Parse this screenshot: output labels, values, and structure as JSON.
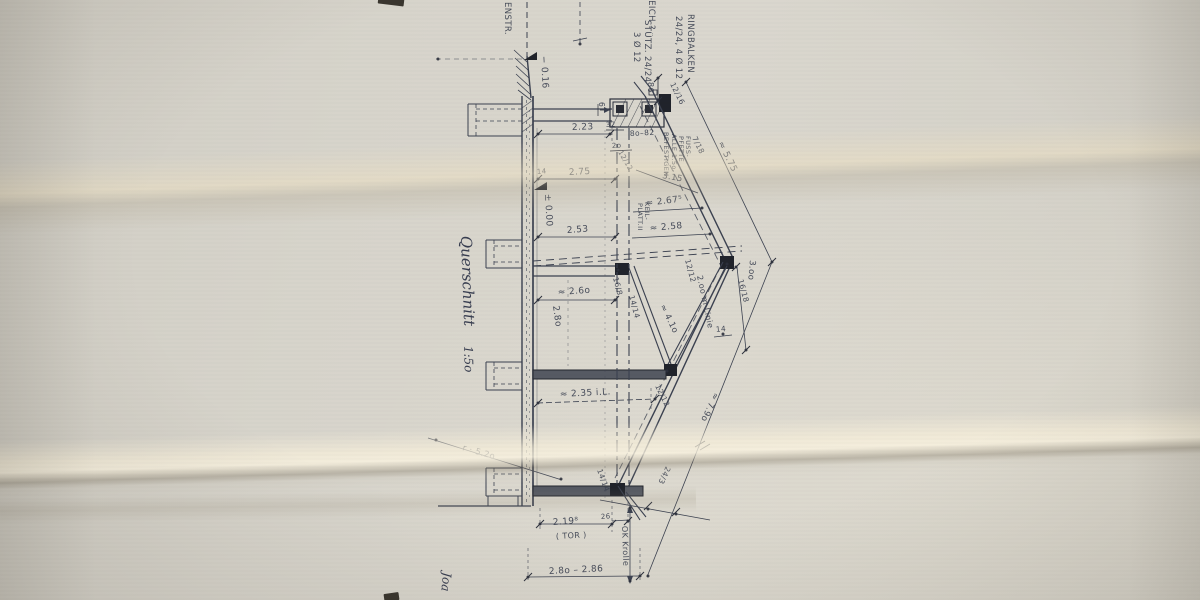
{
  "colors": {
    "paper": "#d6d3ca",
    "ink": "#3b4150",
    "ink_heavy": "#20232b",
    "beam_fill": "#565a63"
  },
  "drawing": {
    "labels": [
      {
        "name": "street-name",
        "text": "ENSTR.",
        "x": 505,
        "y": 2,
        "rot": 90,
        "size": 8.5
      },
      {
        "name": "note-gleich",
        "text": "GLEICH ?",
        "x": 649,
        "y": -12,
        "rot": 90,
        "size": 8.5
      },
      {
        "name": "note-stuetz",
        "text": "STÜTZ. 24/24",
        "x": 645,
        "y": 20,
        "rot": 90,
        "size": 8.5
      },
      {
        "name": "note-stuetz-2",
        "text": "3 Ø 12",
        "x": 634,
        "y": 32,
        "rot": 90,
        "size": 8.5
      },
      {
        "name": "note-ringbalken",
        "text": "RINGBALKEN",
        "x": 688,
        "y": 14,
        "rot": 90,
        "size": 8.5
      },
      {
        "name": "note-ringbalken-2",
        "text": "24/24, 4 Ø 12",
        "x": 676,
        "y": 16,
        "rot": 90,
        "size": 8.5
      },
      {
        "name": "dim-86",
        "text": "86",
        "x": 648,
        "y": 82,
        "rot": 90,
        "size": 8
      },
      {
        "name": "frac-12-16",
        "text": "12/16",
        "x": 670,
        "y": 84,
        "rot": 64,
        "size": 7.5
      },
      {
        "name": "dim-6",
        "text": "6",
        "x": 599,
        "y": 102,
        "rot": 90,
        "size": 7.5
      },
      {
        "name": "dim-2-23",
        "text": "2.23",
        "x": 572,
        "y": 130,
        "rot": -2,
        "size": 9
      },
      {
        "name": "dim-32",
        "text": "32",
        "x": 606,
        "y": 127,
        "rot": -3,
        "size": 7
      },
      {
        "name": "dim-2o",
        "text": "2o",
        "x": 612,
        "y": 148,
        "rot": -3,
        "size": 7
      },
      {
        "name": "dim-8o-82",
        "text": "8o–82",
        "x": 630,
        "y": 136,
        "rot": -3,
        "size": 7.5
      },
      {
        "name": "note-fusspfette-1",
        "text": "FUSS-",
        "x": 686,
        "y": 136,
        "rot": 90,
        "size": 6.5
      },
      {
        "name": "note-fusspfette-2",
        "text": "PFETTE",
        "x": 679,
        "y": 136,
        "rot": 90,
        "size": 6.5
      },
      {
        "name": "note-fusspfette-3",
        "text": "ALLE 1.5o-",
        "x": 672,
        "y": 134,
        "rot": 90,
        "size": 6.5
      },
      {
        "name": "note-fusspfette-4",
        "text": "BEFESTIGEN",
        "x": 664,
        "y": 132,
        "rot": 90,
        "size": 6.5
      },
      {
        "name": "frac-7-18",
        "text": "7/18",
        "x": 692,
        "y": 138,
        "rot": 64,
        "size": 7.5
      },
      {
        "name": "dim-5-75",
        "text": "≈ 5.75",
        "x": 718,
        "y": 143,
        "rot": 64,
        "size": 9
      },
      {
        "name": "dim-3-15",
        "text": "3.15",
        "x": 662,
        "y": 178,
        "rot": 10,
        "size": 8.5
      },
      {
        "name": "dim-2-67",
        "text": "≈ 2.67⁵",
        "x": 646,
        "y": 206,
        "rot": -7,
        "size": 9
      },
      {
        "name": "dim-2-75",
        "text": "2.75",
        "x": 569,
        "y": 175,
        "rot": -3,
        "size": 9
      },
      {
        "name": "dim-14-left",
        "text": "14",
        "x": 537,
        "y": 174,
        "rot": -4,
        "size": 7
      },
      {
        "name": "level-zero",
        "text": "± 0.00",
        "x": 545,
        "y": 194,
        "rot": 87,
        "size": 9
      },
      {
        "name": "level-minus-016",
        "text": "− 0.16",
        "x": 541,
        "y": 56,
        "rot": 87,
        "size": 9
      },
      {
        "name": "dim-2-53",
        "text": "2.53",
        "x": 567,
        "y": 233,
        "rot": -4,
        "size": 9
      },
      {
        "name": "note-keilplatte-1",
        "text": "KEIL-",
        "x": 645,
        "y": 202,
        "rot": 90,
        "size": 6.5
      },
      {
        "name": "note-keilplatte-2",
        "text": "PLATT.II",
        "x": 638,
        "y": 203,
        "rot": 90,
        "size": 6.5
      },
      {
        "name": "dim-2-58",
        "text": "≈ 2.58",
        "x": 650,
        "y": 231,
        "rot": -5,
        "size": 9
      },
      {
        "name": "frac-12-12-top",
        "text": "12/12",
        "x": 618,
        "y": 152,
        "rot": 60,
        "size": 7
      },
      {
        "name": "frac-12-12-a",
        "text": "12/12",
        "x": 685,
        "y": 260,
        "rot": 75,
        "size": 7.5
      },
      {
        "name": "note-2m-linie",
        "text": "2.oo m Linie",
        "x": 697,
        "y": 276,
        "rot": 78,
        "size": 8
      },
      {
        "name": "dim-3-00",
        "text": "3.oo",
        "x": 750,
        "y": 260,
        "rot": 95,
        "size": 8.5
      },
      {
        "name": "frac-16-18",
        "text": "16/18",
        "x": 738,
        "y": 280,
        "rot": 75,
        "size": 7.5
      },
      {
        "name": "dim-14-right",
        "text": "14",
        "x": 716,
        "y": 332,
        "rot": -5,
        "size": 7.5
      },
      {
        "name": "dim-2-60",
        "text": "≈ 2.6o",
        "x": 558,
        "y": 295,
        "rot": -4,
        "size": 9
      },
      {
        "name": "frac-16-8",
        "text": "16/8",
        "x": 613,
        "y": 278,
        "rot": 75,
        "size": 7.5
      },
      {
        "name": "frac-14-14-a",
        "text": "14/14",
        "x": 629,
        "y": 296,
        "rot": 75,
        "size": 7.5
      },
      {
        "name": "dim-2-80",
        "text": "2.8o",
        "x": 553,
        "y": 306,
        "rot": 82,
        "size": 9
      },
      {
        "name": "dim-4-10",
        "text": "≈ 4.1o",
        "x": 660,
        "y": 306,
        "rot": 64,
        "size": 8.5
      },
      {
        "name": "frac-12-12-b",
        "text": "12/12",
        "x": 655,
        "y": 386,
        "rot": 64,
        "size": 7.5
      },
      {
        "name": "dim-7-90",
        "text": "≈ 7.9o",
        "x": 714,
        "y": 392,
        "rot": 115,
        "size": 8.5
      },
      {
        "name": "dim-2-35",
        "text": "≈ 2.35 i.L.",
        "x": 560,
        "y": 397,
        "rot": -3,
        "size": 9
      },
      {
        "name": "frac-14-14-b",
        "text": "14/14",
        "x": 597,
        "y": 470,
        "rot": 70,
        "size": 7.5
      },
      {
        "name": "dim-24-3",
        "text": "24/3",
        "x": 666,
        "y": 466,
        "rot": 115,
        "size": 7.5
      },
      {
        "name": "dim-26",
        "text": "26",
        "x": 601,
        "y": 519,
        "rot": -4,
        "size": 7
      },
      {
        "name": "dim-2-19",
        "text": "2.19⁸",
        "x": 553,
        "y": 525,
        "rot": -4,
        "size": 9
      },
      {
        "name": "dim-tor",
        "text": "( TOR )",
        "x": 556,
        "y": 539,
        "rot": -3,
        "size": 8
      },
      {
        "name": "note-ok-krolle",
        "text": "OK Krolle",
        "x": 622,
        "y": 526,
        "rot": 88,
        "size": 8
      },
      {
        "name": "dim-2-80-2-86",
        "text": "2.8o – 2.86",
        "x": 549,
        "y": 574,
        "rot": -3,
        "size": 9
      },
      {
        "name": "dim-radius",
        "text": "r · 5.2o",
        "x": 462,
        "y": 450,
        "rot": 16,
        "size": 8.5
      },
      {
        "name": "title-querschnitt",
        "text": "Querschnitt",
        "x": 461,
        "y": 236,
        "rot": 88,
        "size": 15,
        "style": "script"
      },
      {
        "name": "title-scale",
        "text": "1:5o",
        "x": 464,
        "y": 346,
        "rot": 88,
        "size": 12,
        "style": "script"
      },
      {
        "name": "signature",
        "text": "Joa",
        "x": 443,
        "y": 572,
        "rot": 95,
        "size": 12,
        "style": "script"
      }
    ]
  }
}
